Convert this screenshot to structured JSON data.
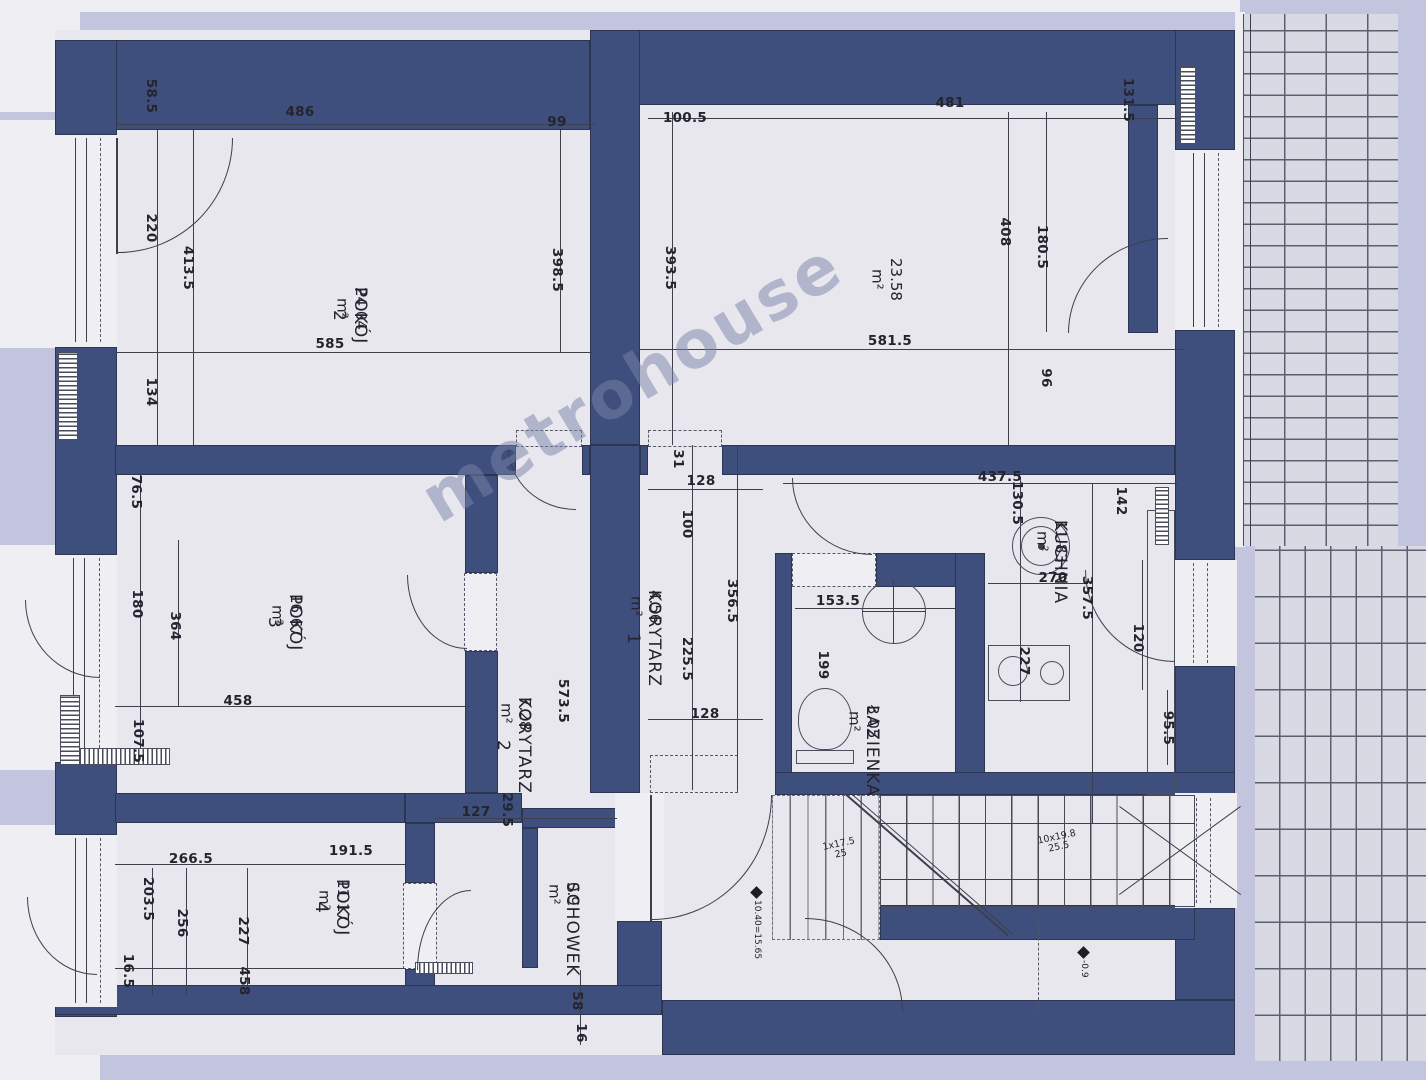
{
  "plan": {
    "watermark": "metrohouse"
  },
  "rooms": [
    {
      "id": "pokoj2",
      "name": "POKÓJ 2",
      "area": "24.04 m²",
      "x": 370,
      "y": 287
    },
    {
      "id": "pokoj3",
      "name": "POKÓJ 3",
      "area": "16.67 m²",
      "x": 305,
      "y": 594
    },
    {
      "id": "room-23",
      "name": "",
      "area": "23.58 m²",
      "x": 905,
      "y": 258
    },
    {
      "id": "kuchnia",
      "name": "KUCHNIA",
      "area": "11.83 m²",
      "x": 1070,
      "y": 520
    },
    {
      "id": "lazienka",
      "name": "ŁAZIENKA",
      "area": "3.05 m²",
      "x": 882,
      "y": 705
    },
    {
      "id": "korytarz1",
      "name": "KORYTARZ 1",
      "area": "4.56 m²",
      "x": 664,
      "y": 590
    },
    {
      "id": "korytarz2",
      "name": "KORYTARZ 2",
      "area": "7.28 m²",
      "x": 534,
      "y": 697
    },
    {
      "id": "schowek",
      "name": "SCHOWEK",
      "area": "0.9 m²",
      "x": 582,
      "y": 882
    },
    {
      "id": "pokoj4",
      "name": "POKÓJ 4",
      "area": "11.17 m²",
      "x": 352,
      "y": 879
    }
  ],
  "dimensions": [
    {
      "v": "58.5",
      "x": 151,
      "y": 96,
      "o": "v"
    },
    {
      "v": "486",
      "x": 300,
      "y": 112,
      "o": "h"
    },
    {
      "v": "99",
      "x": 557,
      "y": 122,
      "o": "h"
    },
    {
      "v": "100.5",
      "x": 685,
      "y": 118,
      "o": "h"
    },
    {
      "v": "481",
      "x": 950,
      "y": 103,
      "o": "h"
    },
    {
      "v": "131.5",
      "x": 1128,
      "y": 100,
      "o": "v"
    },
    {
      "v": "220",
      "x": 151,
      "y": 228,
      "o": "v"
    },
    {
      "v": "413.5",
      "x": 188,
      "y": 268,
      "o": "v"
    },
    {
      "v": "398.5",
      "x": 557,
      "y": 270,
      "o": "v"
    },
    {
      "v": "393.5",
      "x": 670,
      "y": 268,
      "o": "v"
    },
    {
      "v": "408",
      "x": 1005,
      "y": 232,
      "o": "v"
    },
    {
      "v": "180.5",
      "x": 1042,
      "y": 247,
      "o": "v"
    },
    {
      "v": "585",
      "x": 330,
      "y": 344,
      "o": "h"
    },
    {
      "v": "581.5",
      "x": 890,
      "y": 341,
      "o": "h"
    },
    {
      "v": "134",
      "x": 151,
      "y": 392,
      "o": "v"
    },
    {
      "v": "96",
      "x": 1046,
      "y": 378,
      "o": "v"
    },
    {
      "v": "76.5",
      "x": 136,
      "y": 492,
      "o": "v"
    },
    {
      "v": "31",
      "x": 678,
      "y": 459,
      "o": "v"
    },
    {
      "v": "128",
      "x": 701,
      "y": 481,
      "o": "h"
    },
    {
      "v": "100",
      "x": 687,
      "y": 524,
      "o": "v"
    },
    {
      "v": "437.5",
      "x": 1000,
      "y": 477,
      "o": "h"
    },
    {
      "v": "130.5",
      "x": 1017,
      "y": 503,
      "o": "v"
    },
    {
      "v": "142",
      "x": 1121,
      "y": 501,
      "o": "v"
    },
    {
      "v": "356.5",
      "x": 732,
      "y": 601,
      "o": "v"
    },
    {
      "v": "225.5",
      "x": 687,
      "y": 659,
      "o": "v"
    },
    {
      "v": "153.5",
      "x": 838,
      "y": 601,
      "o": "h"
    },
    {
      "v": "199",
      "x": 823,
      "y": 665,
      "o": "v"
    },
    {
      "v": "270",
      "x": 1053,
      "y": 578,
      "o": "h"
    },
    {
      "v": "357.5",
      "x": 1087,
      "y": 598,
      "o": "v"
    },
    {
      "v": "120",
      "x": 1138,
      "y": 638,
      "o": "v"
    },
    {
      "v": "227",
      "x": 1024,
      "y": 661,
      "o": "v"
    },
    {
      "v": "95.5",
      "x": 1168,
      "y": 728,
      "o": "v"
    },
    {
      "v": "128",
      "x": 705,
      "y": 714,
      "o": "h"
    },
    {
      "v": "180",
      "x": 137,
      "y": 604,
      "o": "v"
    },
    {
      "v": "364",
      "x": 175,
      "y": 626,
      "o": "v"
    },
    {
      "v": "458",
      "x": 238,
      "y": 701,
      "o": "h"
    },
    {
      "v": "107.5",
      "x": 138,
      "y": 741,
      "o": "v"
    },
    {
      "v": "573.5",
      "x": 563,
      "y": 701,
      "o": "v"
    },
    {
      "v": "127",
      "x": 476,
      "y": 812,
      "o": "h"
    },
    {
      "v": "29.5",
      "x": 507,
      "y": 810,
      "o": "v"
    },
    {
      "v": "266.5",
      "x": 191,
      "y": 859,
      "o": "h"
    },
    {
      "v": "191.5",
      "x": 351,
      "y": 851,
      "o": "h"
    },
    {
      "v": "203.5",
      "x": 148,
      "y": 899,
      "o": "v"
    },
    {
      "v": "256",
      "x": 182,
      "y": 923,
      "o": "v"
    },
    {
      "v": "227",
      "x": 243,
      "y": 931,
      "o": "v"
    },
    {
      "v": "458",
      "x": 244,
      "y": 981,
      "o": "v"
    },
    {
      "v": "16.5",
      "x": 128,
      "y": 971,
      "o": "v"
    },
    {
      "v": "58",
      "x": 577,
      "y": 1001,
      "o": "v"
    },
    {
      "v": "16",
      "x": 581,
      "y": 1033,
      "o": "v"
    }
  ],
  "stairs": {
    "flight_a_line1": "1x17.5",
    "flight_a_line2": "25",
    "flight_b_line1": "10x19.8",
    "flight_b_line2": "25.5"
  },
  "level_markers": [
    {
      "text": "10.40=15.65",
      "x": 752,
      "y": 888
    },
    {
      "text": "-0.9",
      "x": 1079,
      "y": 948
    }
  ],
  "colors": {
    "wall": "#3f4f7d",
    "floor": "#e9e7ee",
    "margin": "#c3c5de",
    "line": "#3c3f4c",
    "brick_line": "#596070",
    "watermark": "rgba(122,132,168,0.5)"
  }
}
